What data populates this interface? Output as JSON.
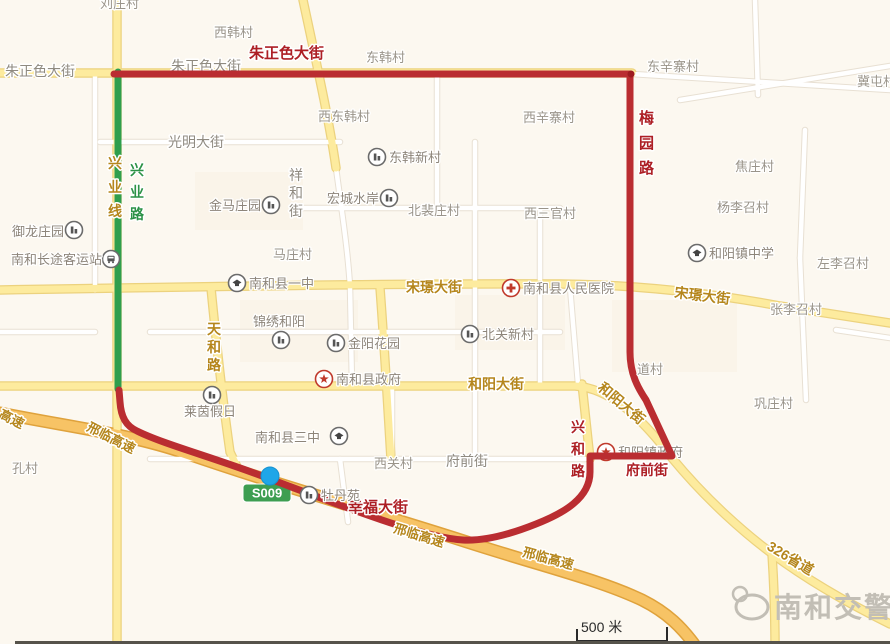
{
  "canvas": {
    "w": 890,
    "h": 644,
    "bg": "#fcf8f0"
  },
  "palette": {
    "road_white": "#ffffff",
    "road_white_casing": "#e8e0d3",
    "road_yellow": "#fdeb9e",
    "road_yellow_casing": "#ecd27e",
    "road_orange": "#f7c365",
    "road_orange_casing": "#dfa23c",
    "route_red": "#ba2d31",
    "route_green": "#2f9e4d",
    "label_gray": "#8f8a80",
    "label_red": "#ad1f25",
    "label_yellow": "#b5861c",
    "label_green": "#2c9247",
    "village": "#9a948a",
    "poi_label": "#8d857a",
    "poi_icon": "#555555",
    "poi_icon_red": "#c0392b",
    "shield_bg": "#3d9e51",
    "shield_text": "#ffffff",
    "block": "#f8f1e5",
    "watermark": "#c2beb5",
    "location_dot": "#1fa6e8",
    "location_dot_edge": "#1792cf",
    "scale": "#2a2a2a",
    "bottom_bar": "#56534b",
    "halo": "#ffffff"
  },
  "blocks": [
    {
      "x": 455,
      "y": 295,
      "w": 110,
      "h": 55
    },
    {
      "x": 195,
      "y": 172,
      "w": 108,
      "h": 58
    },
    {
      "x": 240,
      "y": 300,
      "w": 118,
      "h": 62
    },
    {
      "x": 612,
      "y": 300,
      "w": 125,
      "h": 72
    }
  ],
  "roads": [
    {
      "n": "minor-road",
      "t": "w",
      "d": "M95,73 V290"
    },
    {
      "n": "guangming-street",
      "t": "w",
      "d": "M100,142 H340"
    },
    {
      "n": "xianghe-street",
      "t": "w",
      "d": "M336,168 C342,212 348,252 350,287 L352,385"
    },
    {
      "n": "minor-road",
      "t": "w",
      "d": "M300,208 H560"
    },
    {
      "n": "minor-road",
      "t": "w",
      "d": "M437,74 V208"
    },
    {
      "n": "minor-road",
      "t": "w",
      "d": "M475,142 V456"
    },
    {
      "n": "minor-road",
      "t": "w",
      "d": "M540,208 V385"
    },
    {
      "n": "minor-road",
      "t": "w",
      "d": "M150,332 H560"
    },
    {
      "n": "minor-road",
      "t": "w",
      "d": "M0,332 H95"
    },
    {
      "n": "minor-road",
      "t": "w",
      "d": "M632,74 L890,90"
    },
    {
      "n": "minor-road",
      "t": "w",
      "d": "M800,258 L806,400"
    },
    {
      "n": "minor-road",
      "t": "w",
      "d": "M805,130 L800,258"
    },
    {
      "n": "minor-road",
      "t": "w",
      "d": "M755,0 L758,95"
    },
    {
      "n": "minor-road",
      "t": "w",
      "d": "M680,100 L890,66"
    },
    {
      "n": "fuqian-street",
      "t": "w",
      "d": "M150,459 H588"
    },
    {
      "n": "minor-road",
      "t": "w",
      "d": "M392,385 V459"
    },
    {
      "n": "minor-road",
      "t": "w",
      "d": "M570,287 L578,384"
    },
    {
      "n": "minor-road",
      "t": "w",
      "d": "M340,459 L348,522"
    },
    {
      "n": "minor-road",
      "t": "w",
      "d": "M836,330 L890,338"
    },
    {
      "n": "zhuzhengse-street",
      "t": "y",
      "d": "M0,73 H632"
    },
    {
      "n": "xingye-road",
      "t": "y",
      "d": "M117,0 V644"
    },
    {
      "n": "north-diagonal-road",
      "t": "y",
      "d": "M303,0 C318,70 330,125 336,168"
    },
    {
      "n": "songjing-street",
      "t": "y",
      "d": "M0,290 C180,287 420,283 560,284 C650,285 720,295 780,306 L890,323"
    },
    {
      "n": "tianhe-road",
      "t": "y",
      "d": "M211,288 C217,350 224,410 230,452 L240,473"
    },
    {
      "n": "government-road",
      "t": "y",
      "d": "M380,288 C384,340 388,410 391,459"
    },
    {
      "n": "heyang-street-326",
      "t": "y",
      "d": "M0,386 H575 C610,388 642,418 672,458 C705,498 745,535 785,563 C822,589 858,608 890,624"
    },
    {
      "n": "xinghe-road",
      "t": "y",
      "d": "M582,384 L590,459"
    },
    {
      "n": "326-branch",
      "t": "y",
      "d": "M772,554 C774,585 775,615 775,644"
    },
    {
      "n": "xinglin-expressway",
      "t": "o",
      "d": "M0,413 C70,427 130,434 185,453 C290,489 390,517 470,543 C545,567 600,580 642,600 C668,613 682,628 694,644"
    }
  ],
  "routes": {
    "green": {
      "n": "green-route-xingye",
      "d": "M118,72 V389"
    },
    "red": {
      "n": "red-restriction-boundary",
      "d": "M114,74 L630,74 L630,352 C630,374 638,388 646,400 L672,456 L590,456 L590,472 C590,498 564,513 536,524 C506,536 481,541 463,540 C420,537 345,507 262,476 C212,457 163,444 137,431 C126,426 121,417 120,402 L119,390"
    }
  },
  "red_vertex_dot": {
    "x": 631,
    "y": 74
  },
  "shield": {
    "text": "S009",
    "x": 243,
    "y": 484,
    "w": 48,
    "h": 18
  },
  "street_labels": [
    {
      "t": "朱正色大街",
      "x": 5,
      "y": 76,
      "c": "g"
    },
    {
      "t": "朱正色大街",
      "x": 171,
      "y": 71,
      "c": "g",
      "under": true
    },
    {
      "t": "光明大街",
      "x": 168,
      "y": 147,
      "c": "g"
    },
    {
      "t": "祥和街",
      "x": 289,
      "y": 180,
      "c": "g",
      "vert": true,
      "sp": 18
    },
    {
      "t": "府前街",
      "x": 446,
      "y": 466,
      "c": "g"
    },
    {
      "t": "朱正色大街",
      "x": 249,
      "y": 58,
      "c": "r",
      "size": 15
    },
    {
      "t": "梅园路",
      "x": 639,
      "y": 123,
      "c": "r",
      "vert": true,
      "sp": 25,
      "size": 15
    },
    {
      "t": "兴和路",
      "x": 571,
      "y": 432,
      "c": "r",
      "vert": true,
      "sp": 22,
      "size": 14
    },
    {
      "t": "府前街",
      "x": 626,
      "y": 475,
      "c": "r",
      "size": 14
    },
    {
      "t": "幸福大街",
      "x": 348,
      "y": 512,
      "c": "r",
      "size": 15
    },
    {
      "t": "兴业线",
      "x": 108,
      "y": 168,
      "c": "y",
      "vert": true,
      "sp": 24
    },
    {
      "t": "天和路",
      "x": 207,
      "y": 334,
      "c": "y",
      "vert": true,
      "sp": 18
    },
    {
      "t": "宋璟大街",
      "x": 406,
      "y": 292,
      "c": "y"
    },
    {
      "t": "宋璟大街",
      "x": 674,
      "y": 297,
      "c": "y",
      "rot": 7
    },
    {
      "t": "和阳大街",
      "x": 468,
      "y": 389,
      "c": "y"
    },
    {
      "t": "和阳大街",
      "x": 597,
      "y": 389,
      "c": "y",
      "rot": 40
    },
    {
      "t": "高速",
      "x": -2,
      "y": 417,
      "c": "y",
      "rot": 27,
      "size": 13
    },
    {
      "t": "邢临高速",
      "x": 86,
      "y": 430,
      "c": "y",
      "rot": 27,
      "size": 13
    },
    {
      "t": "邢临高速",
      "x": 393,
      "y": 532,
      "c": "y",
      "rot": 17,
      "size": 13
    },
    {
      "t": "邢临高速",
      "x": 522,
      "y": 556,
      "c": "y",
      "rot": 15,
      "size": 13
    },
    {
      "t": "326省道",
      "x": 766,
      "y": 549,
      "c": "y",
      "rot": 31
    },
    {
      "t": "兴业路",
      "x": 130,
      "y": 175,
      "c": "gr",
      "vert": true,
      "sp": 22
    }
  ],
  "villages": [
    {
      "t": "刘庄村",
      "x": 100,
      "y": 8
    },
    {
      "t": "西韩村",
      "x": 214,
      "y": 37
    },
    {
      "t": "东韩村",
      "x": 366,
      "y": 62
    },
    {
      "t": "东辛寨村",
      "x": 647,
      "y": 71
    },
    {
      "t": "冀屯村",
      "x": 857,
      "y": 86
    },
    {
      "t": "西东韩村",
      "x": 318,
      "y": 121
    },
    {
      "t": "西辛寨村",
      "x": 523,
      "y": 122
    },
    {
      "t": "焦庄村",
      "x": 735,
      "y": 171
    },
    {
      "t": "杨李召村",
      "x": 717,
      "y": 212
    },
    {
      "t": "北裴庄村",
      "x": 408,
      "y": 215
    },
    {
      "t": "西三官村",
      "x": 524,
      "y": 218
    },
    {
      "t": "马庄村",
      "x": 273,
      "y": 259
    },
    {
      "t": "左李召村",
      "x": 817,
      "y": 268
    },
    {
      "t": "张李召村",
      "x": 770,
      "y": 314
    },
    {
      "t": "道村",
      "x": 637,
      "y": 374
    },
    {
      "t": "巩庄村",
      "x": 754,
      "y": 408
    },
    {
      "t": "孔村",
      "x": 12,
      "y": 473
    },
    {
      "t": "西关村",
      "x": 374,
      "y": 468
    }
  ],
  "pois": [
    {
      "type": "building",
      "ix": 74,
      "iy": 230,
      "label": "御龙庄园",
      "lx": 64,
      "ly": 236,
      "anchor": "end"
    },
    {
      "type": "bus",
      "ix": 111,
      "iy": 259,
      "label": "南和长途客运站",
      "lx": 102,
      "ly": 264,
      "anchor": "end"
    },
    {
      "type": "building",
      "ix": 271,
      "iy": 205,
      "label": "金马庄园",
      "lx": 261,
      "ly": 210,
      "anchor": "end"
    },
    {
      "type": "building",
      "ix": 377,
      "iy": 157,
      "label": "东韩新村",
      "lx": 389,
      "ly": 162,
      "anchor": "start"
    },
    {
      "type": "building",
      "ix": 389,
      "iy": 198,
      "label": "宏城水岸",
      "lx": 379,
      "ly": 203,
      "anchor": "end"
    },
    {
      "type": "school",
      "ix": 237,
      "iy": 283,
      "label": "南和县一中",
      "lx": 249,
      "ly": 288,
      "anchor": "start"
    },
    {
      "type": "hospital",
      "ix": 511,
      "iy": 288,
      "label": "南和县人民医院",
      "lx": 523,
      "ly": 293,
      "anchor": "start"
    },
    {
      "type": "school",
      "ix": 697,
      "iy": 253,
      "label": "和阳镇中学",
      "lx": 709,
      "ly": 258,
      "anchor": "start"
    },
    {
      "type": "building",
      "ix": 470,
      "iy": 334,
      "label": "北关新村",
      "lx": 482,
      "ly": 339,
      "anchor": "start"
    },
    {
      "type": "building",
      "ix": 281,
      "iy": 340,
      "label": "锦绣和阳",
      "lx": 253,
      "ly": 326,
      "anchor": "start"
    },
    {
      "type": "building",
      "ix": 336,
      "iy": 343,
      "label": "金阳花园",
      "lx": 348,
      "ly": 348,
      "anchor": "start"
    },
    {
      "type": "gov",
      "ix": 324,
      "iy": 379,
      "label": "南和县政府",
      "lx": 336,
      "ly": 384,
      "anchor": "start"
    },
    {
      "type": "building",
      "ix": 212,
      "iy": 395,
      "label": "莱茵假日",
      "lx": 184,
      "ly": 416,
      "anchor": "start"
    },
    {
      "type": "school",
      "ix": 339,
      "iy": 436,
      "label": "南和县三中",
      "lx": 255,
      "ly": 442,
      "anchor": "start"
    },
    {
      "type": "building",
      "ix": 309,
      "iy": 495,
      "label": "牡丹苑",
      "lx": 321,
      "ly": 500,
      "anchor": "start"
    },
    {
      "type": "gov",
      "ix": 606,
      "iy": 452,
      "label": "和阳镇政府",
      "lx": 618,
      "ly": 457,
      "anchor": "start",
      "under": true
    }
  ],
  "location_dot": {
    "x": 270,
    "y": 476,
    "r": 9
  },
  "scale_bar": {
    "label": "500 米",
    "x": 581,
    "y": 632,
    "path": "M577,629 L577,641 L667,641 L667,627"
  },
  "watermark": {
    "text": "南和交警",
    "x": 774,
    "y": 617
  },
  "bottom_bar": {
    "x": 15,
    "y": 641,
    "w": 875,
    "h": 3
  }
}
